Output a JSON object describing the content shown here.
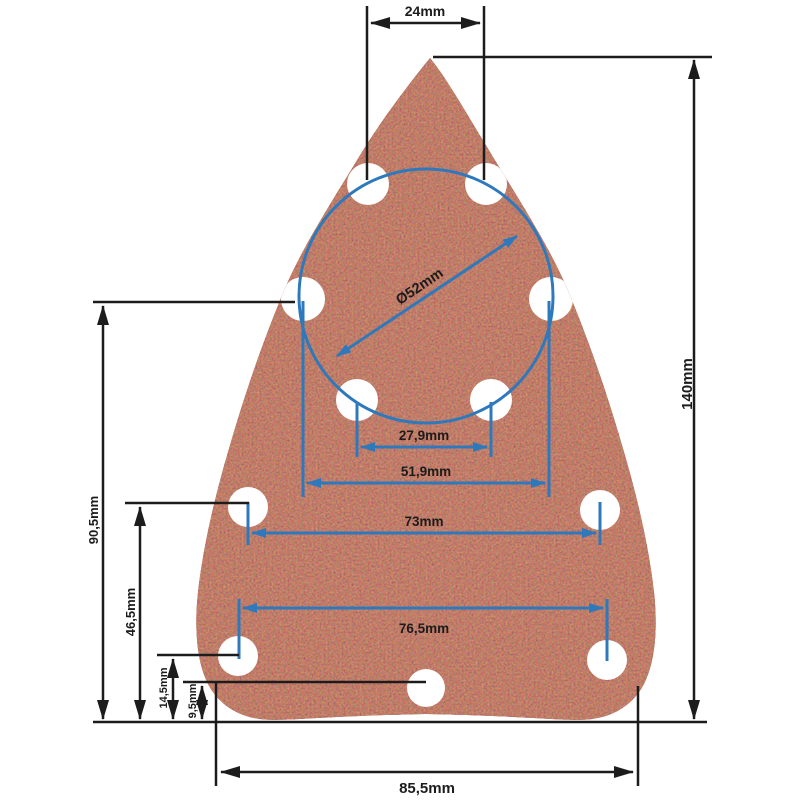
{
  "diagram": {
    "subject": "triangular detail-sander sanding sheet with 11 dust extraction holes",
    "units": "mm",
    "hole_count": 11
  },
  "colors": {
    "background": "#ffffff",
    "dimension_black": "#1c1c1c",
    "dimension_blue": "#2e79bc",
    "pad_base": "#6e2113",
    "pad_grain_light": "#b05a3c",
    "pad_grain_dark": "#4d1308",
    "hole_fill": "#ffffff",
    "label_text": "#1c1c1c"
  },
  "dimensions": {
    "top_hole_spacing": {
      "label": "24mm",
      "value_mm": 24,
      "orientation": "horizontal",
      "line_color": "black"
    },
    "overall_height": {
      "label": "140mm",
      "value_mm": 140,
      "orientation": "vertical",
      "line_color": "black"
    },
    "hole_circle_diameter": {
      "label": "Ø52mm",
      "value_mm": 52,
      "orientation": "diagonal",
      "line_color": "blue"
    },
    "inner_hole_spacing": {
      "label": "27,9mm",
      "value_mm": 27.9,
      "orientation": "horizontal",
      "line_color": "blue"
    },
    "circle_hole_spacing": {
      "label": "51,9mm",
      "value_mm": 51.9,
      "orientation": "horizontal",
      "line_color": "blue"
    },
    "side_hole_spacing": {
      "label": "73mm",
      "value_mm": 73,
      "orientation": "horizontal",
      "line_color": "blue"
    },
    "lower_hole_spacing": {
      "label": "76,5mm",
      "value_mm": 76.5,
      "orientation": "horizontal",
      "line_color": "blue"
    },
    "left_upper_height": {
      "label": "90,5mm",
      "value_mm": 90.5,
      "orientation": "vertical",
      "line_color": "black"
    },
    "left_mid_height": {
      "label": "46,5mm",
      "value_mm": 46.5,
      "orientation": "vertical",
      "line_color": "black"
    },
    "left_lower_height": {
      "label": "14,5mm",
      "value_mm": 14.5,
      "orientation": "vertical",
      "line_color": "black"
    },
    "left_lowest_height": {
      "label": "9,5mm",
      "value_mm": 9.5,
      "orientation": "vertical",
      "line_color": "black"
    },
    "bottom_width": {
      "label": "85,5mm",
      "value_mm": 85.5,
      "orientation": "horizontal",
      "line_color": "black"
    }
  }
}
